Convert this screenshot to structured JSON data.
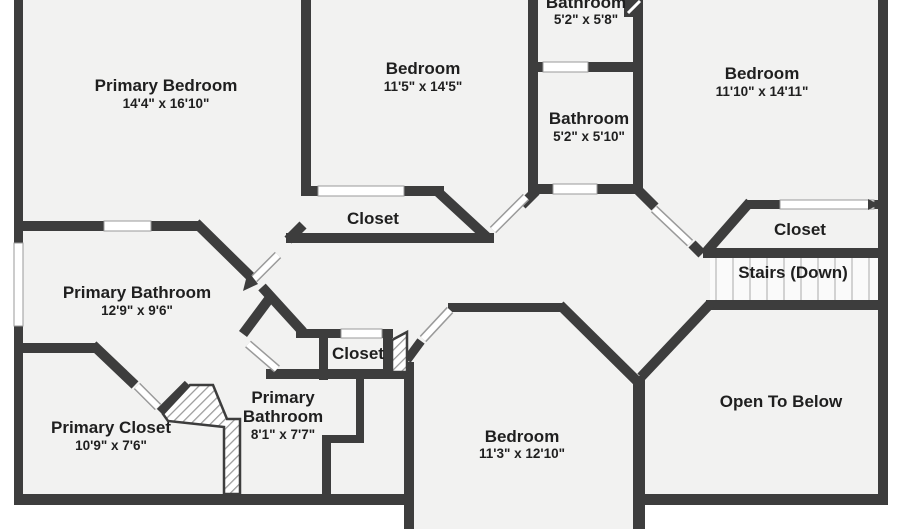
{
  "colors": {
    "wall": "#3d3d3d",
    "floor": "#f2f2f1",
    "outside": "#ffffff",
    "ink": "#1f1f1f",
    "tread": "#c4c4c4",
    "door_edge": "#9a9a9a"
  },
  "rooms": [
    {
      "id": "primary-bedroom",
      "name": "Primary Bedroom",
      "dims": "14'4\" x 16'10\""
    },
    {
      "id": "bedroom-top-middle",
      "name": "Bedroom",
      "dims": "11'5\" x 14'5\""
    },
    {
      "id": "bathroom-top",
      "name": "Bathroom",
      "dims": "5'2\" x 5'8\""
    },
    {
      "id": "bedroom-top-right",
      "name": "Bedroom",
      "dims": "11'10\" x 14'11\""
    },
    {
      "id": "bathroom-middle",
      "name": "Bathroom",
      "dims": "5'2\" x 5'10\""
    },
    {
      "id": "closet-bedroom-middle",
      "name": "Closet"
    },
    {
      "id": "closet-bedroom-right",
      "name": "Closet"
    },
    {
      "id": "stairs",
      "name": "Stairs (Down)"
    },
    {
      "id": "primary-bathroom",
      "name": "Primary Bathroom",
      "dims": "12'9\" x 9'6\""
    },
    {
      "id": "closet-hall",
      "name": "Closet"
    },
    {
      "id": "primary-bathroom-2",
      "name_lines": [
        "Primary",
        "Bathroom"
      ],
      "dims": "8'1\" x 7'7\""
    },
    {
      "id": "primary-closet",
      "name": "Primary Closet",
      "dims": "10'9\" x 7'6\""
    },
    {
      "id": "bedroom-bottom",
      "name": "Bedroom",
      "dims": "11'3\" x 12'10\""
    },
    {
      "id": "open-to-below",
      "name": "Open To Below"
    }
  ]
}
